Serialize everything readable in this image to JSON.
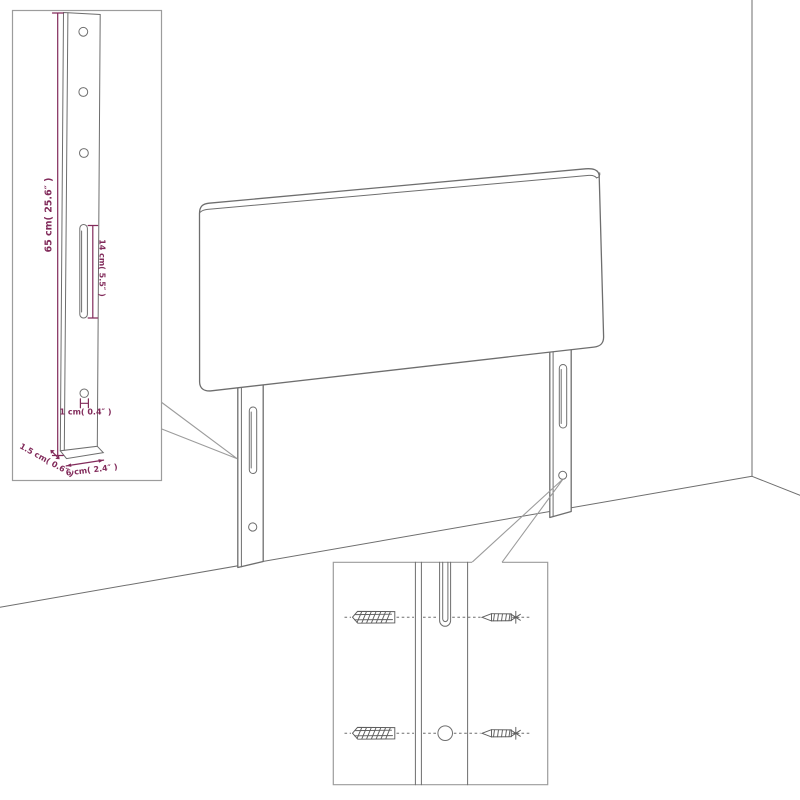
{
  "palette": {
    "background": "#ffffff",
    "line": "#6e6e6e",
    "hardware_line": "#5e5e5e",
    "inset_border": "#9c9c9c",
    "dimension": "#822b5b"
  },
  "diagram": {
    "type": "product-assembly-diagram",
    "subject": "headboard-with-mounting-legs",
    "dimensions": {
      "leg_height": "65 cm( 25.6″ )",
      "slot_length": "14 cm( 5.5″ )",
      "hole_diameter": "1 cm( 0.4″ )",
      "leg_thickness": "1.5 cm( 0.6″ )",
      "leg_width": "6 cm( 2.4″ )"
    },
    "icons": {
      "wall_anchor": "wall-anchor-icon",
      "screw": "screw-icon",
      "mounting_slot": "mounting-slot",
      "mounting_hole": "mounting-hole"
    }
  }
}
